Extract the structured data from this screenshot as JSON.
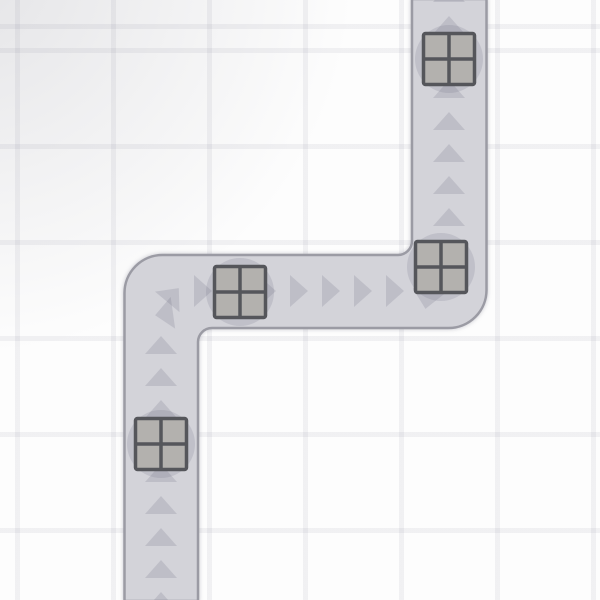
{
  "canvas": {
    "width": 600,
    "height": 600,
    "background": "#fdfdfd"
  },
  "grid": {
    "cell_size": 96,
    "line_width": 5,
    "offset_x": 15,
    "offset_y": 48,
    "line_color": "rgba(70,70,100,0.065)",
    "vignette_color": "rgba(105,105,120,0.17)"
  },
  "road": {
    "fill": "#d3d3d9",
    "border_color": "#9b9ba4",
    "border_width": 2.5,
    "width": 74,
    "outer_corner_radius": 38,
    "inner_corner_radius": 14,
    "path": "M124.5,601 L124.5,293 A38,38 0 0 1 162.5,255 L398,255 A14,14 0 0 0 412,241 L412,-1 L486.5,-1 L486.5,290 A38,38 0 0 1 448.5,328 L212,328 A14,14 0 0 0 198,342 L198,601 Z",
    "segments": [
      {
        "type": "vertical",
        "direction": "up",
        "center_x": 161,
        "from_y": 600,
        "to_y": 291
      },
      {
        "type": "horizontal",
        "direction": "right",
        "center_y": 291,
        "from_x": 161,
        "to_x": 449
      },
      {
        "type": "vertical",
        "direction": "up",
        "center_x": 449,
        "from_y": 291,
        "to_y": 0
      }
    ]
  },
  "arrows": {
    "shape": {
      "base": 32,
      "height": 18
    },
    "fill": "rgba(90,90,115,0.17)",
    "items": [
      {
        "x": 161,
        "y": 601,
        "rot": 0
      },
      {
        "x": 161,
        "y": 569,
        "rot": 0
      },
      {
        "x": 161,
        "y": 537,
        "rot": 0
      },
      {
        "x": 161,
        "y": 505,
        "rot": 0
      },
      {
        "x": 161,
        "y": 473,
        "rot": 0
      },
      {
        "x": 161,
        "y": 441,
        "rot": 0
      },
      {
        "x": 161,
        "y": 409,
        "rot": 0
      },
      {
        "x": 161,
        "y": 377,
        "rot": 0
      },
      {
        "x": 161,
        "y": 345,
        "rot": 0
      },
      {
        "x": 164,
        "y": 314,
        "rot": 262
      },
      {
        "x": 173,
        "y": 295,
        "rot": 40
      },
      {
        "x": 203,
        "y": 291,
        "rot": 90
      },
      {
        "x": 235,
        "y": 291,
        "rot": 90
      },
      {
        "x": 267,
        "y": 291,
        "rot": 90
      },
      {
        "x": 299,
        "y": 291,
        "rot": 90
      },
      {
        "x": 331,
        "y": 291,
        "rot": 90
      },
      {
        "x": 363,
        "y": 291,
        "rot": 90
      },
      {
        "x": 395,
        "y": 291,
        "rot": 90
      },
      {
        "x": 427,
        "y": 300,
        "rot": 190
      },
      {
        "x": 449,
        "y": 249,
        "rot": 0
      },
      {
        "x": 449,
        "y": 217,
        "rot": 0
      },
      {
        "x": 449,
        "y": 185,
        "rot": 0
      },
      {
        "x": 449,
        "y": 153,
        "rot": 0
      },
      {
        "x": 449,
        "y": 121,
        "rot": 0
      },
      {
        "x": 449,
        "y": 89,
        "rot": 0
      },
      {
        "x": 449,
        "y": 57,
        "rot": 0
      },
      {
        "x": 449,
        "y": 25,
        "rot": 0
      },
      {
        "x": 449,
        "y": -7,
        "rot": 0
      }
    ]
  },
  "crates": {
    "size": 51,
    "pane_fill": "#b3b1ae",
    "border_color": "#55565b",
    "border_width": 3.5,
    "corner_radius": 2,
    "halo_radius": 34,
    "halo_fill": "rgba(100,100,125,0.17)",
    "items": [
      {
        "x": 449,
        "y": 59
      },
      {
        "x": 441,
        "y": 267
      },
      {
        "x": 240,
        "y": 292
      },
      {
        "x": 161,
        "y": 444
      }
    ]
  }
}
